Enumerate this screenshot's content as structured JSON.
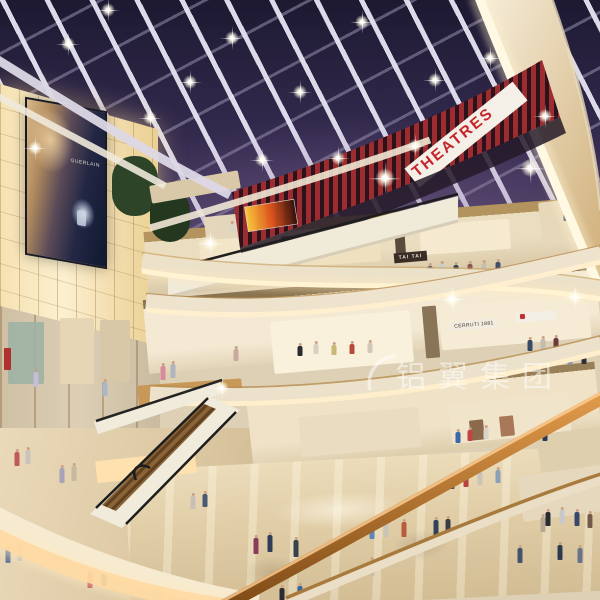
{
  "meta": {
    "description": "Architectural rendering of a multi-level shopping mall atrium at night: glass skylight ceiling with star lights, red cinema level with THEATRES sign, glowing lightbox wall with perfume billboard, curved cream balcony fascias, escalators and shoppers on a polished beige floor."
  },
  "signs": {
    "theatres": "THEATRES",
    "tai_tai": "TAI TAI",
    "cerruti": "CERRUTI 1881",
    "billboard_brand": "GUERLAIN"
  },
  "watermark": {
    "text": "铝翼集团"
  },
  "palette": {
    "night_sky": "#342b4f",
    "skylight_beam": "#e6e4f2",
    "theatre_red": "#c5262c",
    "slat_red": "#b23336",
    "fascia_cream": "#ece1c9",
    "cove_glow": "#ffd9a2",
    "lightbox": "#fcf0cf",
    "wood": "#c89858",
    "handrail_wood": "#c27a2e",
    "floor_beige": "#e0cda6"
  },
  "scene": {
    "sparkles": [
      [
        68,
        44,
        1
      ],
      [
        150,
        118,
        1
      ],
      [
        232,
        38,
        1
      ],
      [
        300,
        92,
        1
      ],
      [
        362,
        22,
        1
      ],
      [
        262,
        160,
        1
      ],
      [
        190,
        82,
        1
      ],
      [
        415,
        146,
        1
      ],
      [
        338,
        158,
        1
      ],
      [
        490,
        58,
        1
      ],
      [
        545,
        116,
        1
      ],
      [
        35,
        148,
        1
      ],
      [
        435,
        80,
        1
      ],
      [
        108,
        10,
        1
      ],
      [
        385,
        178,
        1.4
      ],
      [
        210,
        243,
        1.2
      ],
      [
        452,
        299,
        1.3
      ],
      [
        575,
        297,
        1.1
      ],
      [
        530,
        168,
        1.3
      ],
      [
        222,
        388,
        1
      ]
    ],
    "rects": [
      [
        112,
        156,
        46,
        60,
        "#2e4428",
        1,
        0,
        22
      ],
      [
        150,
        190,
        40,
        52,
        "#243820",
        1,
        0,
        20
      ],
      [
        8,
        322,
        36,
        62,
        "#9fb2a4",
        0.9,
        0,
        2
      ],
      [
        60,
        318,
        34,
        66,
        "#e6d6b6",
        1,
        0,
        2
      ],
      [
        100,
        320,
        30,
        62,
        "#d8c8a8",
        1,
        0,
        2
      ],
      [
        4,
        348,
        7,
        22,
        "#b03030",
        1,
        0,
        1
      ],
      [
        138,
        382,
        104,
        20,
        "#c89858",
        1,
        -4,
        2
      ],
      [
        150,
        178,
        90,
        18,
        "#d9c9a8",
        1,
        -10,
        2
      ],
      [
        205,
        214,
        60,
        26,
        "#e4d6ba",
        1,
        -6,
        2
      ],
      [
        200,
        238,
        70,
        34,
        "#f3e6c8",
        1,
        -4,
        2
      ],
      [
        300,
        230,
        80,
        34,
        "#efe0c0",
        1,
        -4,
        2
      ],
      [
        420,
        222,
        90,
        30,
        "#f5ead0",
        1,
        -4,
        2
      ],
      [
        540,
        200,
        50,
        40,
        "#e8d8ba",
        1,
        -6,
        2
      ],
      [
        282,
        236,
        12,
        30,
        "#6a5a48",
        1,
        -4,
        1
      ],
      [
        395,
        226,
        10,
        28,
        "#5a4a3c",
        1,
        -4,
        1
      ],
      [
        272,
        316,
        140,
        52,
        "#faf1dc",
        1,
        -5,
        2
      ],
      [
        440,
        300,
        150,
        44,
        "#f6ecd6",
        1,
        -5,
        2
      ],
      [
        424,
        306,
        14,
        52,
        "#8a7458",
        1,
        -5,
        1
      ],
      [
        516,
        312,
        40,
        9,
        "#f4efe6",
        1,
        -5,
        1
      ],
      [
        520,
        314,
        5,
        5,
        "#c03030",
        1,
        -5,
        1
      ],
      [
        300,
        412,
        120,
        40,
        "#eadcc0",
        1,
        -5,
        2
      ],
      [
        450,
        398,
        120,
        40,
        "#f0e4ca",
        1,
        -6,
        2
      ],
      [
        470,
        420,
        14,
        20,
        "#8a6a4a",
        1,
        -6,
        1
      ],
      [
        500,
        416,
        14,
        20,
        "#a87858",
        1,
        -6,
        1
      ],
      [
        540,
        430,
        70,
        60,
        "#decfae",
        1,
        -8,
        2
      ],
      [
        520,
        470,
        90,
        46,
        "#e6d8bc",
        1,
        -8,
        2
      ],
      [
        96,
        456,
        100,
        22,
        "#ffe2ae",
        0.95,
        -6,
        2
      ]
    ],
    "people": [
      [
        566,
        212,
        9,
        "#30486a"
      ],
      [
        576,
        214,
        9,
        "#8a4a42"
      ],
      [
        232,
        224,
        8,
        "#d8d4cc"
      ],
      [
        241,
        225,
        8,
        "#5a6a80"
      ],
      [
        294,
        276,
        11,
        "#c8c4bc"
      ],
      [
        306,
        274,
        11,
        "#3a4a6a"
      ],
      [
        322,
        276,
        11,
        "#7a8494"
      ],
      [
        430,
        266,
        10,
        "#4a5a74"
      ],
      [
        442,
        264,
        10,
        "#caccd0"
      ],
      [
        456,
        265,
        10,
        "#32405c"
      ],
      [
        470,
        264,
        10,
        "#8a5a50"
      ],
      [
        484,
        263,
        10,
        "#c8beb0"
      ],
      [
        498,
        262,
        10,
        "#405068"
      ],
      [
        152,
        300,
        12,
        "#b0485a"
      ],
      [
        163,
        300,
        12,
        "#c8c0b4"
      ],
      [
        236,
        349,
        12,
        "#c8a8a0"
      ],
      [
        530,
        340,
        11,
        "#384a66"
      ],
      [
        543,
        339,
        11,
        "#c4bcae"
      ],
      [
        556,
        338,
        11,
        "#6a3a3a"
      ],
      [
        584,
        352,
        12,
        "#2e2e38"
      ],
      [
        570,
        353,
        12,
        "#8a93a4"
      ],
      [
        300,
        346,
        10,
        "#2a2a30"
      ],
      [
        316,
        344,
        10,
        "#d8d0c0"
      ],
      [
        334,
        345,
        10,
        "#c8b878"
      ],
      [
        352,
        344,
        10,
        "#b84a3c"
      ],
      [
        370,
        343,
        10,
        "#d0c8b8"
      ],
      [
        163,
        366,
        14,
        "#d88a9a"
      ],
      [
        173,
        364,
        14,
        "#b0b4bc"
      ],
      [
        36,
        372,
        15,
        "#c8bcd8"
      ],
      [
        105,
        382,
        14,
        "#a8b8c8"
      ],
      [
        458,
        432,
        11,
        "#3a68a8"
      ],
      [
        470,
        430,
        11,
        "#c04444"
      ],
      [
        486,
        428,
        11,
        "#d8d4c8"
      ],
      [
        545,
        430,
        11,
        "#2a3a54"
      ],
      [
        466,
        474,
        13,
        "#b84040"
      ],
      [
        480,
        472,
        13,
        "#cac4b8"
      ],
      [
        452,
        476,
        13,
        "#3c4c68"
      ],
      [
        498,
        470,
        13,
        "#88a0b8"
      ],
      [
        548,
        512,
        14,
        "#2a2a32"
      ],
      [
        562,
        510,
        14,
        "#c8c8cc"
      ],
      [
        577,
        512,
        14,
        "#38486a"
      ],
      [
        590,
        514,
        14,
        "#745a4a"
      ],
      [
        543,
        517,
        15,
        "#b8a890"
      ],
      [
        17,
        452,
        14,
        "#c05a5a"
      ],
      [
        28,
        450,
        14,
        "#c8c4bc"
      ],
      [
        62,
        468,
        15,
        "#a8a4b8"
      ],
      [
        74,
        466,
        15,
        "#c8b8a0"
      ],
      [
        90,
        572,
        16,
        "#b84a4a"
      ],
      [
        104,
        570,
        16,
        "#3a4a40"
      ],
      [
        8,
        548,
        15,
        "#6a7a9a"
      ],
      [
        20,
        546,
        15,
        "#c8c0b0"
      ],
      [
        193,
        496,
        13,
        "#c8c0b4"
      ],
      [
        205,
        494,
        13,
        "#4a5a74"
      ],
      [
        256,
        538,
        16,
        "#8a3a5a"
      ],
      [
        270,
        535,
        17,
        "#2e3c58"
      ],
      [
        296,
        540,
        17,
        "#38424e"
      ],
      [
        372,
        524,
        15,
        "#5a86b8"
      ],
      [
        386,
        522,
        15,
        "#c8c4b8"
      ],
      [
        404,
        522,
        15,
        "#b85a3c"
      ],
      [
        436,
        520,
        16,
        "#324258"
      ],
      [
        448,
        519,
        16,
        "#3c3c46"
      ],
      [
        372,
        560,
        16,
        "#c8beae"
      ],
      [
        520,
        548,
        15,
        "#44526e"
      ],
      [
        560,
        545,
        15,
        "#2e3a50"
      ],
      [
        580,
        548,
        15,
        "#6a7488"
      ],
      [
        300,
        586,
        16,
        "#3a66a0"
      ],
      [
        282,
        588,
        16,
        "#2c2c34"
      ]
    ]
  }
}
